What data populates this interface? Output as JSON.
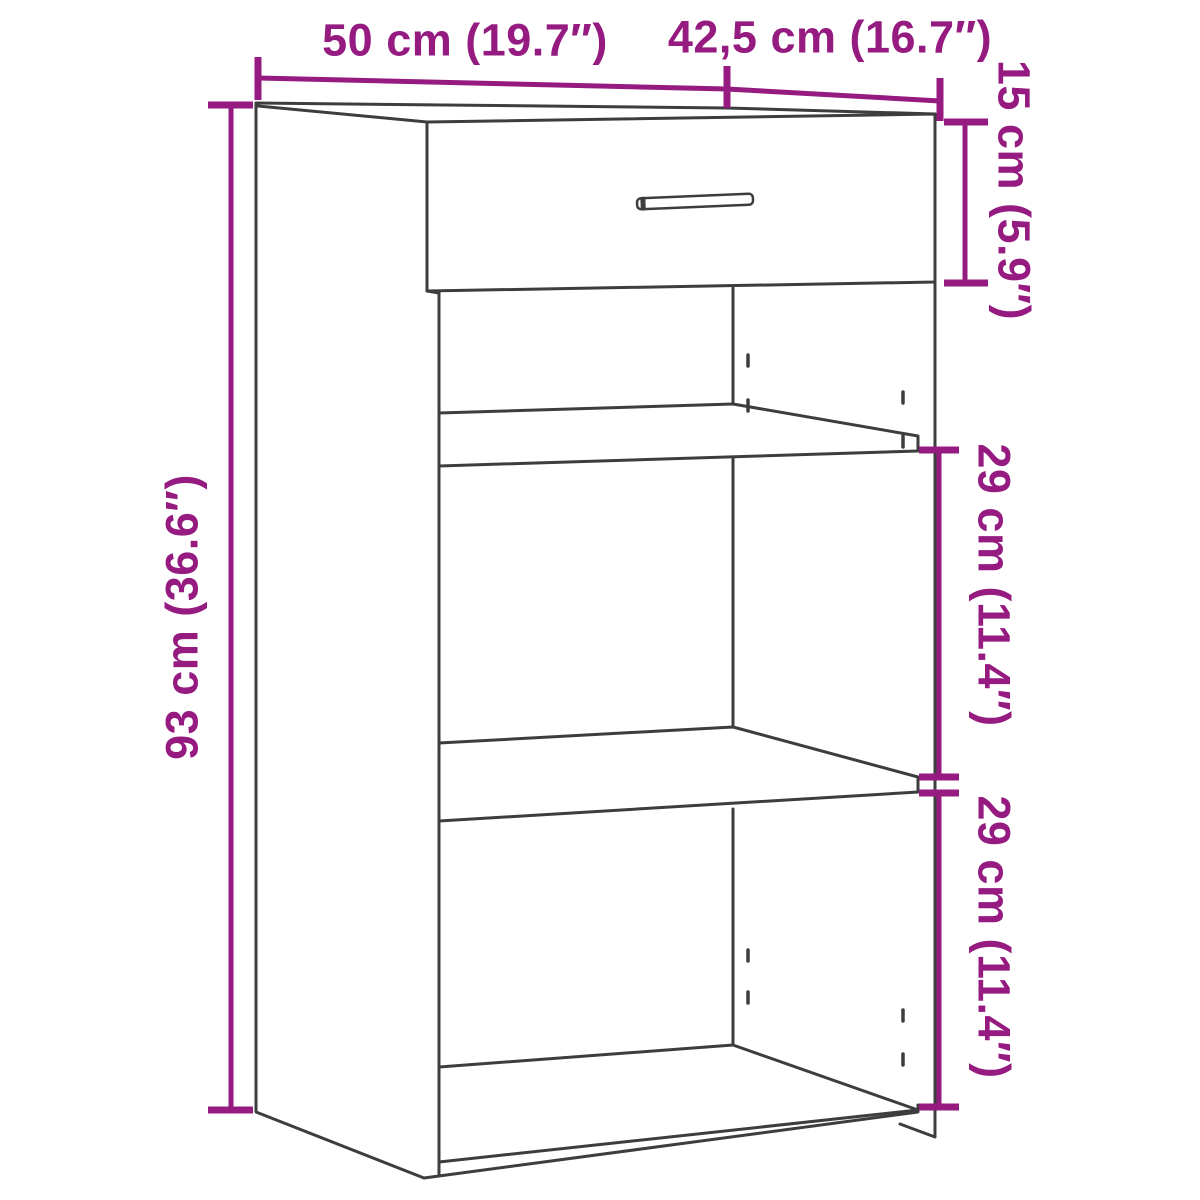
{
  "diagram": {
    "type": "furniture-dimension-diagram",
    "subject": "cabinet with one drawer, two shelves and open compartments",
    "colors": {
      "dimension": "#951b81",
      "outline": "#3d3d3d",
      "background": "#ffffff"
    },
    "dimensions": [
      {
        "id": "width",
        "label": "50 cm (19.7″)",
        "value_cm": 50,
        "value_in": 19.7,
        "orientation": "horizontal",
        "position": "top-left"
      },
      {
        "id": "depth",
        "label": "42,5 cm (16.7″)",
        "value_cm": 42.5,
        "value_in": 16.7,
        "orientation": "horizontal",
        "position": "top-right"
      },
      {
        "id": "drawer-height",
        "label": "15 cm (5.9″)",
        "value_cm": 15,
        "value_in": 5.9,
        "orientation": "vertical",
        "position": "right-upper"
      },
      {
        "id": "total-height",
        "label": "93 cm (36.6″)",
        "value_cm": 93,
        "value_in": 36.6,
        "orientation": "vertical",
        "position": "left"
      },
      {
        "id": "shelf-space-upper",
        "label": "29 cm (11.4″)",
        "value_cm": 29,
        "value_in": 11.4,
        "orientation": "vertical",
        "position": "right-middle"
      },
      {
        "id": "shelf-space-lower",
        "label": "29 cm (11.4″)",
        "value_cm": 29,
        "value_in": 11.4,
        "orientation": "vertical",
        "position": "right-lower"
      }
    ]
  }
}
